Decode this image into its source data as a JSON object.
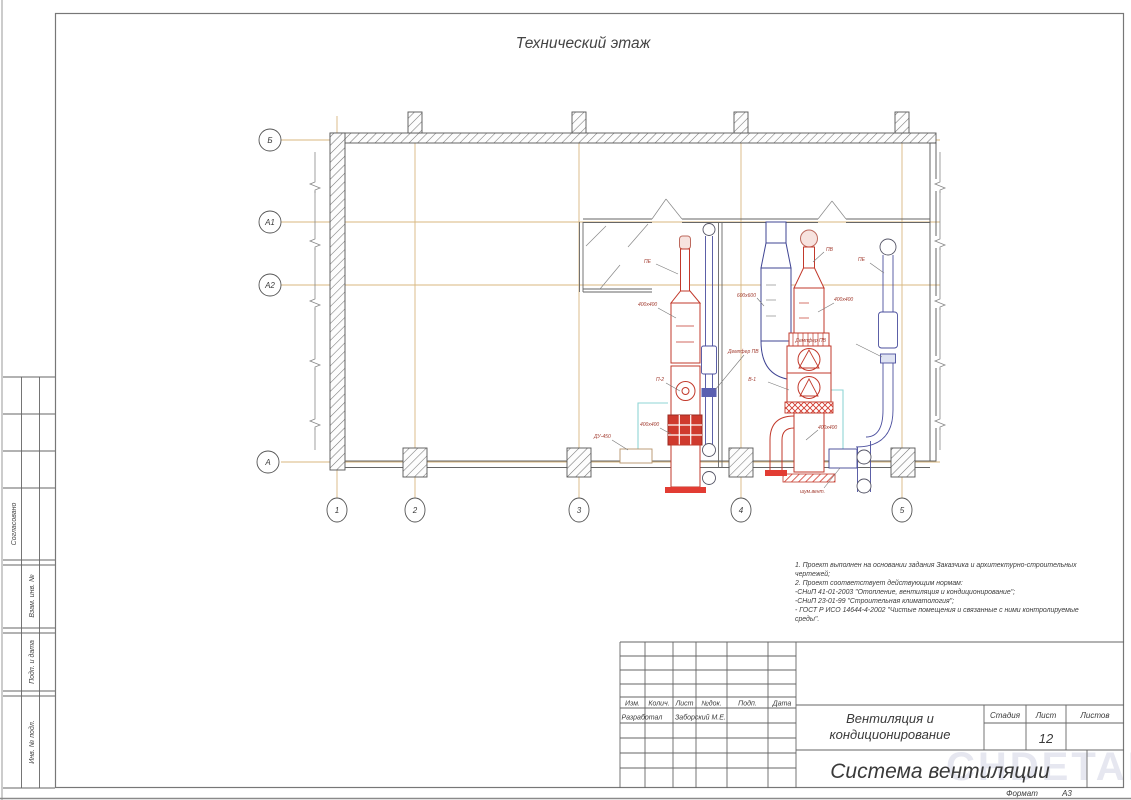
{
  "sheet": {
    "plan_title": "Технический этаж",
    "format_label": "Формат",
    "format_value": "А3",
    "watermark": "CHDETAL"
  },
  "axes": {
    "r1": "Б",
    "r2": "А1",
    "r3": "А2",
    "r4": "А",
    "c1": "1",
    "c2": "2",
    "c3": "3",
    "c4": "4",
    "c5": "5"
  },
  "labels": {
    "l1": "ПЕ",
    "l2": "400х400",
    "l3": "П-2",
    "l4": "400х400",
    "l5": "ДУ-450",
    "l6": "Демпфер ПВ",
    "l7": "ПВ",
    "l8": "400х400",
    "l9": "В-1",
    "l10": "600х600",
    "l11": "400х400",
    "l12": "шум.вент.",
    "l13": "ПЕ",
    "l14": "Демпфер ПВ"
  },
  "notes": {
    "line1": "1. Проект выполнен на основании задания Заказчика и архитектурно-строительных",
    "line2": "чертежей;",
    "line3": "2. Проект соответствует действующим нормам:",
    "line4": "-СНиП 41-01-2003 \"Отопление, вентиляция и кондиционирование\";",
    "line5": "-СНиП 23-01-99 \"Строительная климатология\";",
    "line6": "- ГОСТ Р ИСО 14644-4-2002 \"Чистые помещения и связанные с ними контролируемые",
    "line7": "среды\"."
  },
  "stamp": {
    "col_izm": "Изм.",
    "col_kol": "Колич.",
    "col_list": "Лист",
    "col_doc": "№док.",
    "col_podp": "Подп.",
    "col_data": "Дата",
    "role": "Разработал",
    "name": "Заборский М.Е.",
    "project_line1": "Вентиляция и",
    "project_line2": "кондиционирование",
    "doc_title": "Система вентиляции",
    "stage_label": "Стадия",
    "sheet_label": "Лист",
    "sheets_label": "Листов",
    "sheet_number": "12"
  },
  "side": {
    "agreed": "Согласовано",
    "vzam": "Взам. инв. №",
    "podp": "Подп. и дата",
    "inv": "Инв. № подл."
  }
}
